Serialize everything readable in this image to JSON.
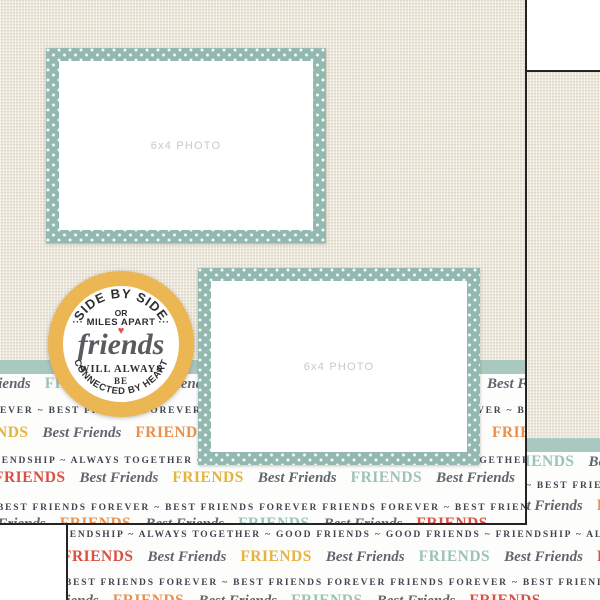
{
  "product": {
    "photo_placeholder": "6x4 PHOTO"
  },
  "badge": {
    "arc_top": "SIDE BY SIDE",
    "line_or": "OR",
    "line_miles": "··· MILES APART ···",
    "heart_icon": "♥",
    "word_main": "friends",
    "line_will": "WILL ALWAYS",
    "line_be": "BE",
    "arc_bottom": "CONNECTED BY HEART"
  },
  "colors": {
    "linen": "#e9e3d6",
    "teal_frame": "#92b8b0",
    "teal_band": "#a9c8c0",
    "teal_word": "#9cc2ba",
    "red": "#d94f43",
    "orange": "#e8914e",
    "yellow": "#e5b33e",
    "caps": "#3f4551",
    "script": "#61666e",
    "gold": "#ecb653",
    "heart": "#e2574a",
    "edge": "#242424"
  },
  "front_rows": [
    {
      "top": 374,
      "indent": -55,
      "kind": "block",
      "segments": [
        {
          "text": "Best Friends",
          "style": "script"
        },
        {
          "text": "FRIENDS",
          "style": "teal"
        },
        {
          "text": "Best Friends",
          "style": "script"
        },
        {
          "text": "FRIENDS",
          "style": "red"
        },
        {
          "text": "Best Friends",
          "style": "script"
        },
        {
          "text": "FRIENDS",
          "style": "teal"
        },
        {
          "text": "Best Friends",
          "style": "script"
        },
        {
          "text": "FRIENDS",
          "style": "red"
        }
      ]
    },
    {
      "top": 403,
      "indent": 0,
      "kind": "caps",
      "segments": [
        {
          "text": "EVER ~ BEST FRIENDS FOREVER ~ BEST FRIENDS FOREVER ~ FRIENDS FOREVER ~ BEST FRIE",
          "style": "caps"
        }
      ]
    },
    {
      "top": 423,
      "indent": -50,
      "kind": "block",
      "segments": [
        {
          "text": "FRIENDS",
          "style": "yellow"
        },
        {
          "text": "Best Friends",
          "style": "script"
        },
        {
          "text": "FRIENDS",
          "style": "orange"
        },
        {
          "text": "Best Friends",
          "style": "script"
        },
        {
          "text": "FRIENDS",
          "style": "yellow"
        },
        {
          "text": "Best Friends",
          "style": "script"
        },
        {
          "text": "FRIENDS",
          "style": "orange"
        }
      ]
    },
    {
      "top": 453,
      "indent": -20,
      "kind": "caps",
      "segments": [
        {
          "text": "FRIENDSHIP ~ ALWAYS TOGETHER ~ GOOD FRIENDS ~ FRIENDSHIP ~ ALWAYS TOGETHER ~ GOOD FR",
          "style": "caps"
        }
      ]
    },
    {
      "top": 468,
      "indent": -13,
      "kind": "block",
      "segments": [
        {
          "text": "FRIENDS",
          "style": "red"
        },
        {
          "text": "Best Friends",
          "style": "script"
        },
        {
          "text": "FRIENDS",
          "style": "yellow"
        },
        {
          "text": "Best Friends",
          "style": "script"
        },
        {
          "text": "FRIENDS",
          "style": "teal"
        },
        {
          "text": "Best Friends",
          "style": "script"
        },
        {
          "text": "FRIENDS",
          "style": "red"
        }
      ]
    },
    {
      "top": 500,
      "indent": -3,
      "kind": "caps",
      "segments": [
        {
          "text": "BEST FRIENDS FOREVER ~ BEST FRIENDS FOREVER FRIENDS FOREVER ~ BEST FRIENDS FOREVER ~ BE",
          "style": "caps"
        }
      ]
    },
    {
      "top": 514,
      "indent": -40,
      "kind": "block",
      "segments": [
        {
          "text": "Best Friends",
          "style": "script"
        },
        {
          "text": "FRIENDS",
          "style": "orange"
        },
        {
          "text": "Best Friends",
          "style": "script"
        },
        {
          "text": "FRIENDS",
          "style": "teal"
        },
        {
          "text": "Best Friends",
          "style": "script"
        },
        {
          "text": "FRIENDS",
          "style": "red"
        }
      ]
    }
  ],
  "back_rows": [
    {
      "top": 380,
      "indent": 428,
      "kind": "block",
      "segments": [
        {
          "text": "FRIENDS",
          "style": "teal"
        },
        {
          "text": "Best Friends",
          "style": "script"
        },
        {
          "text": "FRIENDS",
          "style": "red"
        }
      ]
    },
    {
      "top": 406,
      "indent": 458,
      "kind": "caps",
      "segments": [
        {
          "text": "~ BEST FRIENDS FOREVER ~ BEST FR",
          "style": "caps"
        }
      ]
    },
    {
      "top": 424,
      "indent": 429,
      "kind": "block",
      "segments": [
        {
          "text": "Best Friends",
          "style": "script"
        },
        {
          "text": "FRIENDS",
          "style": "orange"
        },
        {
          "text": "Best Friends",
          "style": "script"
        }
      ]
    },
    {
      "top": 455,
      "indent": -20,
      "kind": "caps",
      "segments": [
        {
          "text": "FRIENDSHIP ~ ALWAYS TOGETHER ~ GOOD FRIENDS ~ GOOD FRIENDS ~ FRIENDSHIP ~ ALWAYS TOGETHER ~ GO",
          "style": "caps"
        }
      ]
    },
    {
      "top": 475,
      "indent": -13,
      "kind": "block",
      "segments": [
        {
          "text": "FRIENDS",
          "style": "red"
        },
        {
          "text": "Best Friends",
          "style": "script"
        },
        {
          "text": "FRIENDS",
          "style": "yellow"
        },
        {
          "text": "Best Friends",
          "style": "script"
        },
        {
          "text": "FRIENDS",
          "style": "teal"
        },
        {
          "text": "Best Friends",
          "style": "script"
        },
        {
          "text": "FRIENDS",
          "style": "red"
        },
        {
          "text": "Best Friends",
          "style": "script"
        }
      ]
    },
    {
      "top": 503,
      "indent": -3,
      "kind": "caps",
      "segments": [
        {
          "text": "BEST FRIENDS FOREVER ~ BEST FRIENDS FOREVER FRIENDS FOREVER ~ BEST FRIENDS FOREVER ~ BEST FRI",
          "style": "caps"
        }
      ]
    },
    {
      "top": 519,
      "indent": -55,
      "kind": "block",
      "segments": [
        {
          "text": "Best Friends",
          "style": "script"
        },
        {
          "text": "FRIENDS",
          "style": "orange"
        },
        {
          "text": "Best Friends",
          "style": "script"
        },
        {
          "text": "FRIENDS",
          "style": "teal"
        },
        {
          "text": "Best Friends",
          "style": "script"
        },
        {
          "text": "FRIENDS",
          "style": "red"
        }
      ]
    }
  ]
}
